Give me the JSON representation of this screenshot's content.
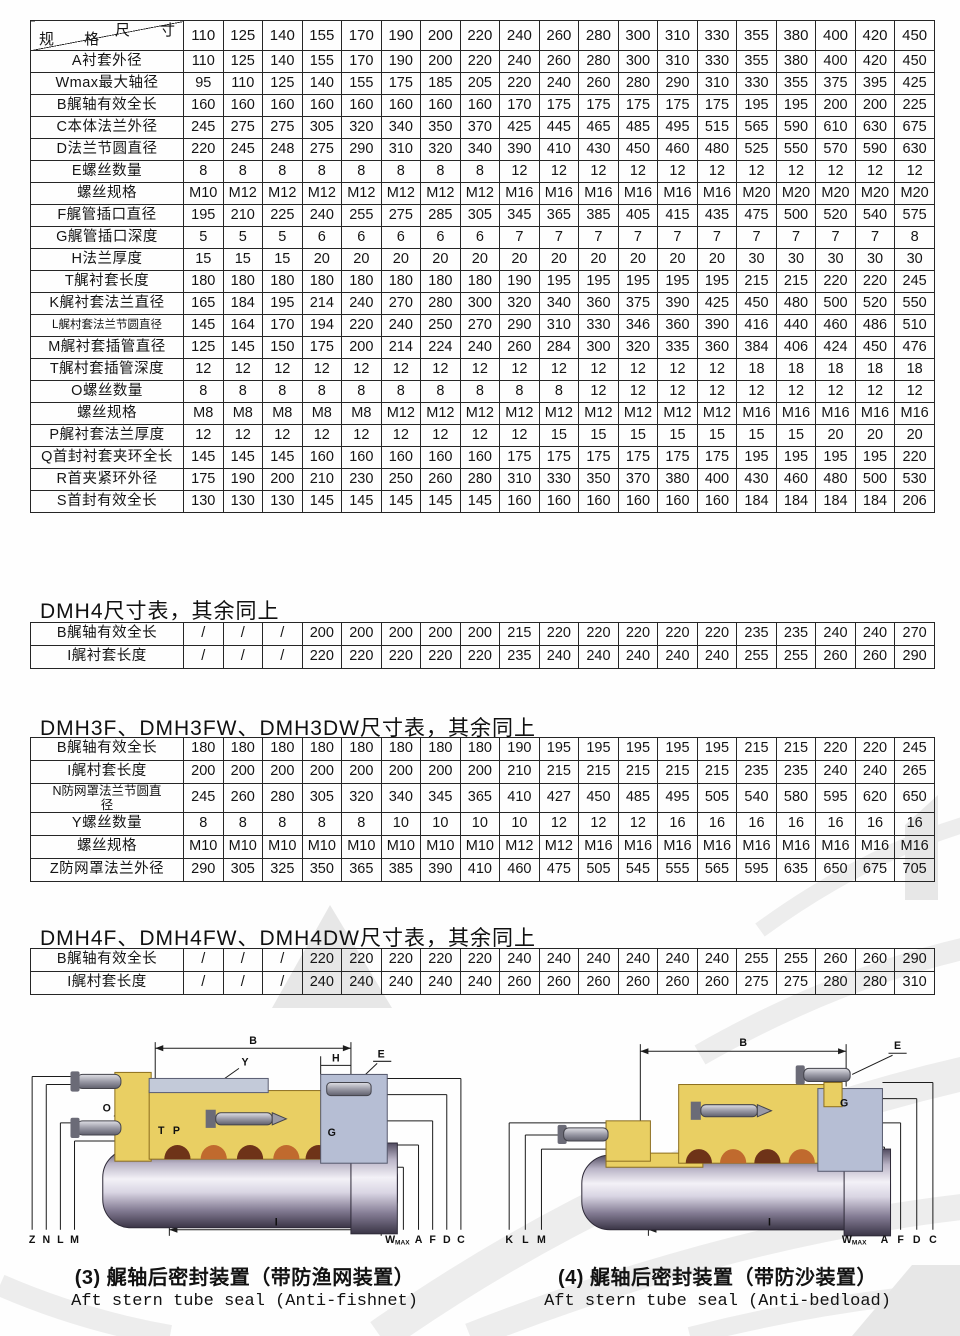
{
  "main_table": {
    "corner_top": "尺 寸",
    "corner_bottom": "规 格",
    "sizes": [
      110,
      125,
      140,
      155,
      170,
      190,
      200,
      220,
      240,
      260,
      280,
      300,
      310,
      330,
      355,
      380,
      400,
      420,
      450
    ],
    "rows": [
      {
        "label": "A衬套外径",
        "values": [
          110,
          125,
          140,
          155,
          170,
          190,
          200,
          220,
          240,
          260,
          280,
          300,
          310,
          330,
          355,
          380,
          400,
          420,
          450
        ]
      },
      {
        "label": "Wmax最大轴径",
        "values": [
          95,
          110,
          125,
          140,
          155,
          175,
          185,
          205,
          220,
          240,
          260,
          280,
          290,
          310,
          330,
          355,
          375,
          395,
          425
        ]
      },
      {
        "label": "B艉轴有效全长",
        "values": [
          160,
          160,
          160,
          160,
          160,
          160,
          160,
          160,
          170,
          175,
          175,
          175,
          175,
          175,
          195,
          195,
          200,
          200,
          225
        ]
      },
      {
        "label": "C本体法兰外径",
        "values": [
          245,
          275,
          275,
          305,
          320,
          340,
          350,
          370,
          425,
          445,
          465,
          485,
          495,
          515,
          565,
          590,
          610,
          630,
          675
        ]
      },
      {
        "label": "D法兰节圆直径",
        "values": [
          220,
          245,
          248,
          275,
          290,
          310,
          320,
          340,
          390,
          410,
          430,
          450,
          460,
          480,
          525,
          550,
          570,
          590,
          630
        ]
      },
      {
        "label": "E螺丝数量",
        "values": [
          8,
          8,
          8,
          8,
          8,
          8,
          8,
          8,
          12,
          12,
          12,
          12,
          12,
          12,
          12,
          12,
          12,
          12,
          12
        ]
      },
      {
        "label": "螺丝规格",
        "values": [
          "M10",
          "M12",
          "M12",
          "M12",
          "M12",
          "M12",
          "M12",
          "M12",
          "M16",
          "M16",
          "M16",
          "M16",
          "M16",
          "M16",
          "M20",
          "M20",
          "M20",
          "M20",
          "M20"
        ]
      },
      {
        "label": "F艉管插口直径",
        "values": [
          195,
          210,
          225,
          240,
          255,
          275,
          285,
          305,
          345,
          365,
          385,
          405,
          415,
          435,
          475,
          500,
          520,
          540,
          575
        ]
      },
      {
        "label": "G艉管插口深度",
        "values": [
          5,
          5,
          5,
          6,
          6,
          6,
          6,
          6,
          7,
          7,
          7,
          7,
          7,
          7,
          7,
          7,
          7,
          7,
          8
        ]
      },
      {
        "label": "H法兰厚度",
        "values": [
          15,
          15,
          15,
          20,
          20,
          20,
          20,
          20,
          20,
          20,
          20,
          20,
          20,
          20,
          30,
          30,
          30,
          30,
          30
        ]
      },
      {
        "label": "T艉衬套长度",
        "values": [
          180,
          180,
          180,
          180,
          180,
          180,
          180,
          180,
          190,
          195,
          195,
          195,
          195,
          195,
          215,
          215,
          220,
          220,
          245
        ]
      },
      {
        "label": "K艉衬套法兰直径",
        "values": [
          165,
          184,
          195,
          214,
          240,
          270,
          280,
          300,
          320,
          340,
          360,
          375,
          390,
          425,
          450,
          480,
          500,
          520,
          550
        ]
      },
      {
        "label": "L艉村套法兰节圆直径",
        "values": [
          145,
          164,
          170,
          194,
          220,
          240,
          250,
          270,
          290,
          310,
          330,
          346,
          360,
          390,
          416,
          440,
          460,
          486,
          510
        ]
      },
      {
        "label": "M艉衬套插管直径",
        "values": [
          125,
          145,
          150,
          175,
          200,
          214,
          224,
          240,
          260,
          284,
          300,
          320,
          335,
          360,
          384,
          406,
          424,
          450,
          476
        ]
      },
      {
        "label": "T艉村套插管深度",
        "values": [
          12,
          12,
          12,
          12,
          12,
          12,
          12,
          12,
          12,
          12,
          12,
          12,
          12,
          12,
          18,
          18,
          18,
          18,
          18
        ]
      },
      {
        "label": "O螺丝数量",
        "values": [
          8,
          8,
          8,
          8,
          8,
          8,
          8,
          8,
          8,
          8,
          12,
          12,
          12,
          12,
          12,
          12,
          12,
          12,
          12
        ]
      },
      {
        "label": "螺丝规格",
        "values": [
          "M8",
          "M8",
          "M8",
          "M8",
          "M8",
          "M12",
          "M12",
          "M12",
          "M12",
          "M12",
          "M12",
          "M12",
          "M12",
          "M12",
          "M16",
          "M16",
          "M16",
          "M16",
          "M16"
        ]
      },
      {
        "label": "P艉衬套法兰厚度",
        "values": [
          12,
          12,
          12,
          12,
          12,
          12,
          12,
          12,
          12,
          15,
          15,
          15,
          15,
          15,
          15,
          15,
          20,
          20,
          20
        ]
      },
      {
        "label": "Q首封衬套夹环全长",
        "values": [
          145,
          145,
          145,
          160,
          160,
          160,
          160,
          160,
          175,
          175,
          175,
          175,
          175,
          175,
          195,
          195,
          195,
          195,
          220
        ]
      },
      {
        "label": "R首夹紧环外径",
        "values": [
          175,
          190,
          200,
          210,
          230,
          250,
          260,
          280,
          310,
          330,
          350,
          370,
          380,
          400,
          430,
          460,
          480,
          500,
          530
        ]
      },
      {
        "label": "S首封有效全长",
        "values": [
          130,
          130,
          130,
          145,
          145,
          145,
          145,
          145,
          160,
          160,
          160,
          160,
          160,
          160,
          184,
          184,
          184,
          184,
          206
        ]
      }
    ]
  },
  "sections": [
    {
      "title": "DMH4尺寸表，其余同上",
      "table": {
        "rows": [
          {
            "label": "B艉轴有效全长",
            "values": [
              "/",
              "/",
              "/",
              200,
              200,
              200,
              200,
              200,
              215,
              220,
              220,
              220,
              220,
              220,
              235,
              235,
              240,
              240,
              270
            ]
          },
          {
            "label": "I艉衬套长度",
            "values": [
              "/",
              "/",
              "/",
              220,
              220,
              220,
              220,
              220,
              235,
              240,
              240,
              240,
              240,
              240,
              255,
              255,
              260,
              260,
              290
            ]
          }
        ]
      }
    },
    {
      "title": "DMH3F、DMH3FW、DMH3DW尺寸表，其余同上",
      "table": {
        "rows": [
          {
            "label": "B艉轴有效全长",
            "values": [
              180,
              180,
              180,
              180,
              180,
              180,
              180,
              180,
              190,
              195,
              195,
              195,
              195,
              195,
              215,
              215,
              220,
              220,
              245
            ]
          },
          {
            "label": "I艉村套长度",
            "values": [
              200,
              200,
              200,
              200,
              200,
              200,
              200,
              200,
              210,
              215,
              215,
              215,
              215,
              215,
              235,
              235,
              240,
              240,
              265
            ]
          },
          {
            "label": "N防网罩法兰节圆直径",
            "values": [
              245,
              260,
              280,
              305,
              320,
              340,
              345,
              365,
              410,
              427,
              450,
              485,
              495,
              505,
              540,
              580,
              595,
              620,
              650
            ]
          },
          {
            "label": "Y螺丝数量",
            "values": [
              8,
              8,
              8,
              8,
              8,
              10,
              10,
              10,
              10,
              12,
              12,
              12,
              16,
              16,
              16,
              16,
              16,
              16,
              16
            ]
          },
          {
            "label": "螺丝规格",
            "values": [
              "M10",
              "M10",
              "M10",
              "M10",
              "M10",
              "M10",
              "M10",
              "M10",
              "M12",
              "M12",
              "M16",
              "M16",
              "M16",
              "M16",
              "M16",
              "M16",
              "M16",
              "M16",
              "M16"
            ]
          },
          {
            "label": "Z防网罩法兰外径",
            "values": [
              290,
              305,
              325,
              350,
              365,
              385,
              390,
              410,
              460,
              475,
              505,
              545,
              555,
              565,
              595,
              635,
              650,
              675,
              705
            ]
          }
        ]
      }
    },
    {
      "title": "DMH4F、DMH4FW、DMH4DW尺寸表，其余同上",
      "table": {
        "rows": [
          {
            "label": "B艉轴有效全长",
            "values": [
              "/",
              "/",
              "/",
              220,
              220,
              220,
              220,
              220,
              240,
              240,
              240,
              240,
              240,
              240,
              255,
              255,
              260,
              260,
              290
            ]
          },
          {
            "label": "I艉村套长度",
            "values": [
              "/",
              "/",
              "/",
              240,
              240,
              240,
              240,
              240,
              260,
              260,
              260,
              260,
              260,
              260,
              275,
              275,
              280,
              280,
              310
            ]
          }
        ]
      }
    }
  ],
  "diagrams": [
    {
      "caption_zh": "(3) 艉轴后密封装置（带防渔网装置）",
      "caption_en": "Aft stern tube seal (Anti-fishnet)",
      "labels": {
        "b": "B",
        "y": "Y",
        "h": "H",
        "e": "E",
        "o": "O",
        "t": "T",
        "p": "P",
        "g": "G",
        "z": "Z",
        "n": "N",
        "l": "L",
        "m": "M",
        "i": "I",
        "w": "W",
        "w_sub": "MAX",
        "a": "A",
        "f": "F",
        "d": "D",
        "c": "C"
      }
    },
    {
      "caption_zh": "(4) 艉轴后密封装置（带防沙装置）",
      "caption_en": "Aft stern tube seal (Anti-bedload)",
      "labels": {
        "b": "B",
        "e": "E",
        "g": "G",
        "k": "K",
        "l": "L",
        "m": "M",
        "i": "I",
        "w": "W",
        "w_sub": "MAX",
        "a": "A",
        "f": "F",
        "d": "D",
        "c": "C"
      }
    }
  ]
}
